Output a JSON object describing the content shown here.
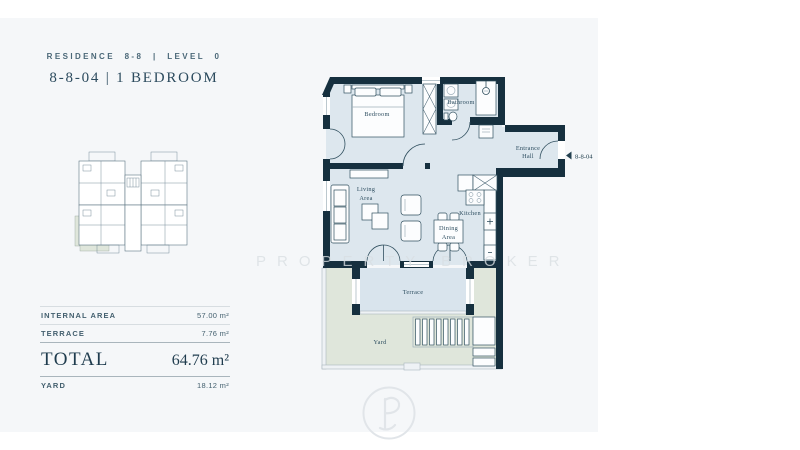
{
  "header": {
    "residence_line": "RESIDENCE 8-8 | LEVEL 0",
    "unit_line": "8-8-04 | 1 BEDROOM"
  },
  "area_table": {
    "rows": [
      {
        "label": "INTERNAL AREA",
        "value": "57.00 m²"
      },
      {
        "label": "TERRACE",
        "value": "7.76 m²"
      }
    ],
    "total_label": "TOTAL",
    "total_value": "64.76 m²",
    "yard_label": "YARD",
    "yard_value": "18.12 m²"
  },
  "floor_plan": {
    "unit_tag": "8-8-04",
    "rooms": {
      "bedroom": "Bedroom",
      "bathroom": "Bathroom",
      "entrance_line1": "Entrance",
      "entrance_line2": "Hall",
      "living_line1": "Living",
      "living_line2": "Area",
      "kitchen": "Kitchen",
      "dining_line1": "Dining",
      "dining_line2": "Area",
      "terrace": "Terrace",
      "yard": "Yard"
    }
  },
  "watermark": {
    "text": "PROPERTY BROKER",
    "monogram": "P"
  },
  "colors": {
    "wall": "#16303f",
    "floor": "#dde7ee",
    "terrace": "#d9e4ed",
    "yard": "#dfe6db",
    "keyplan_highlight": "#ccdce8",
    "accent_text": "#2c4b5e"
  }
}
